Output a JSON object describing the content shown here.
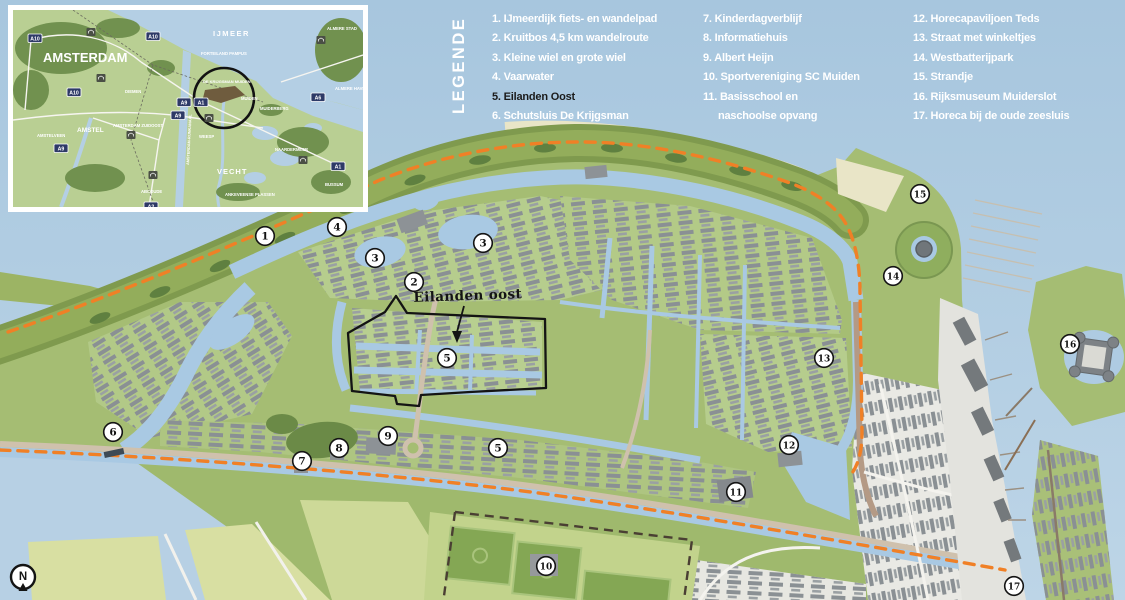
{
  "legend": {
    "title": "LEGENDE",
    "col1": [
      "1. IJmeerdijk fiets- en wandelpad",
      "2. Kruitbos 4,5 km wandelroute",
      "3. Kleine wiel en grote wiel",
      "4. Vaarwater",
      "5. Eilanden Oost",
      "6. Schutsluis De Krijgsman"
    ],
    "col2": [
      "7. Kinderdagverblijf",
      "8. Informatiehuis",
      "9.  Albert Heijn",
      "10. Sportvereniging SC Muiden",
      "11. Basisschool en",
      "naschoolse opvang"
    ],
    "col3": [
      "12. Horecapaviljoen Teds",
      "13. Straat met winkeltjes",
      "14. Westbatterijpark",
      "15. Strandje",
      "16. Rijksmuseum Muiderslot",
      "17. Horeca bij de oude zeesluis"
    ]
  },
  "map": {
    "area_label": "Eilanden oost",
    "compass_label": "N",
    "markers": [
      {
        "n": "1",
        "x": 265,
        "y": 236
      },
      {
        "n": "4",
        "x": 337,
        "y": 227
      },
      {
        "n": "3",
        "x": 375,
        "y": 258
      },
      {
        "n": "3",
        "x": 483,
        "y": 243
      },
      {
        "n": "2",
        "x": 414,
        "y": 282
      },
      {
        "n": "5",
        "x": 447,
        "y": 358
      },
      {
        "n": "6",
        "x": 113,
        "y": 432
      },
      {
        "n": "7",
        "x": 302,
        "y": 461
      },
      {
        "n": "8",
        "x": 339,
        "y": 448
      },
      {
        "n": "9",
        "x": 388,
        "y": 436
      },
      {
        "n": "5",
        "x": 498,
        "y": 448
      },
      {
        "n": "11",
        "x": 736,
        "y": 492
      },
      {
        "n": "12",
        "x": 789,
        "y": 445
      },
      {
        "n": "10",
        "x": 546,
        "y": 566
      },
      {
        "n": "13",
        "x": 824,
        "y": 358
      },
      {
        "n": "14",
        "x": 893,
        "y": 276
      },
      {
        "n": "15",
        "x": 920,
        "y": 194
      },
      {
        "n": "16",
        "x": 1070,
        "y": 344
      },
      {
        "n": "17",
        "x": 1014,
        "y": 586
      }
    ]
  },
  "inset": {
    "labels": [
      {
        "t": "AMSTERDAM",
        "x": 30,
        "y": 52,
        "s": 13
      },
      {
        "t": "IJMEER",
        "x": 200,
        "y": 26,
        "s": 7.5,
        "ls": 1.5
      },
      {
        "t": "VECHT",
        "x": 204,
        "y": 164,
        "s": 7.5,
        "ls": 1
      },
      {
        "t": "AMSTEL",
        "x": 64,
        "y": 122,
        "s": 6.5
      },
      {
        "t": "FORTEILAND PAMPUS",
        "x": 188,
        "y": 45,
        "s": 4.2
      },
      {
        "t": "DE KRIJGSMAN MUIDEN",
        "x": 190,
        "y": 73,
        "s": 4.0
      },
      {
        "t": "MUIDEN",
        "x": 228,
        "y": 90,
        "s": 4.2
      },
      {
        "t": "MUIDERBERG",
        "x": 247,
        "y": 100,
        "s": 4.2
      },
      {
        "t": "WEESP",
        "x": 186,
        "y": 128,
        "s": 4.2
      },
      {
        "t": "DIEMEN",
        "x": 112,
        "y": 83,
        "s": 4.2
      },
      {
        "t": "AMSTELVEEN",
        "x": 24,
        "y": 127,
        "s": 4.2
      },
      {
        "t": "AMSTERDAM ZUIDOOST",
        "x": 100,
        "y": 117,
        "s": 4.2
      },
      {
        "t": "ABCOUDE",
        "x": 128,
        "y": 183,
        "s": 4.2
      },
      {
        "t": "ALMERE STAD",
        "x": 314,
        "y": 20,
        "s": 4.2
      },
      {
        "t": "ALMERE HAVEN",
        "x": 322,
        "y": 80,
        "s": 4.2
      },
      {
        "t": "NAARDERMEER",
        "x": 262,
        "y": 141,
        "s": 4.2
      },
      {
        "t": "ANKEVEENSE PLASSEN",
        "x": 212,
        "y": 186,
        "s": 4.2
      },
      {
        "t": "BUSSUM",
        "x": 312,
        "y": 176,
        "s": 4.2
      },
      {
        "t": "AMSTERDAM-RIJNKANAAL",
        "x": 176,
        "y": 155,
        "s": 3.8,
        "rot": -87
      }
    ],
    "shields": [
      {
        "t": "A10",
        "x": 15,
        "y": 24
      },
      {
        "t": "A10",
        "x": 133,
        "y": 22
      },
      {
        "t": "A10",
        "x": 54,
        "y": 78
      },
      {
        "t": "A9",
        "x": 158,
        "y": 101
      },
      {
        "t": "A9",
        "x": 41,
        "y": 134
      },
      {
        "t": "A2",
        "x": 131,
        "y": 192
      },
      {
        "t": "A1",
        "x": 318,
        "y": 152
      },
      {
        "t": "A6",
        "x": 298,
        "y": 83
      },
      {
        "t": "A9",
        "x": 164,
        "y": 88
      },
      {
        "t": "A1",
        "x": 181,
        "y": 88
      }
    ],
    "forts": [
      [
        78,
        22
      ],
      [
        88,
        68
      ],
      [
        118,
        125
      ],
      [
        140,
        165
      ],
      [
        290,
        150
      ],
      [
        308,
        30
      ],
      [
        196,
        108
      ]
    ]
  },
  "colors": {
    "route_orange": "#f08026",
    "water": "#aecbe2",
    "outline_black": "#141414",
    "legend_text": "#ffffff"
  }
}
